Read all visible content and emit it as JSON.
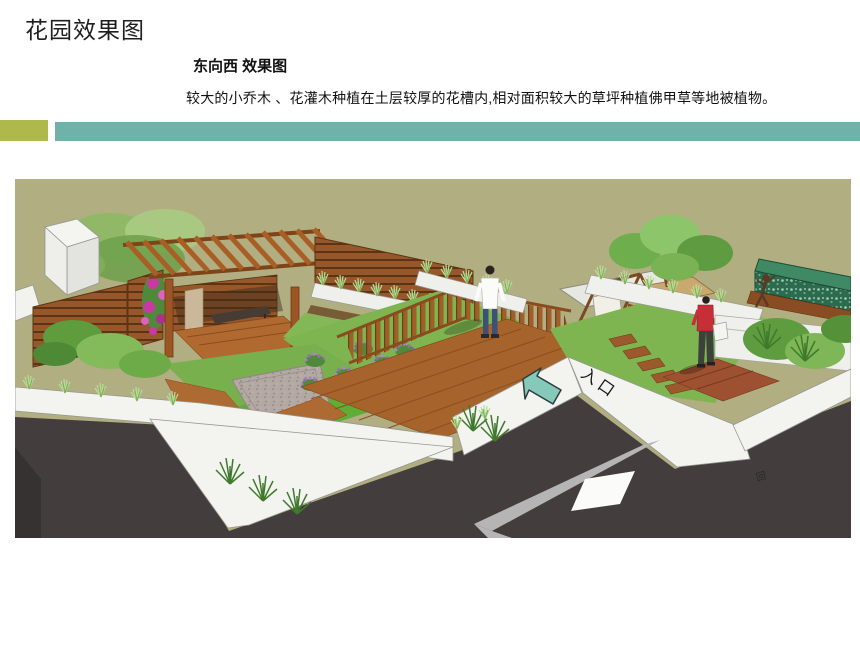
{
  "slide": {
    "title": "花园效果图",
    "caption": {
      "heading": "东向西 效果图",
      "body": "较大的小乔木 、花灌木种植在土层较厚的花槽内,相对面积较大的草坪种植佛甲草等地被植物。"
    },
    "accents": {
      "olive_block": "#aeb94b",
      "teal_bar": "#6fb2a9"
    },
    "rendering": {
      "entrance_label": "入口",
      "pavement_mark": "回",
      "palette": {
        "ground_olive": "#b1ae82",
        "street_asphalt": "#433d3d",
        "road_stripe": "#b5b5b5",
        "parapet_white": "#f3f3f0",
        "wood_brown": "#a05c28",
        "deck_brown": "#a6632b",
        "lawn_green": "#7fb551",
        "arrow_teal": "#85c9bb",
        "hedge_green": "#2c6b4d",
        "flower_magenta": "#c83aa2"
      }
    }
  }
}
